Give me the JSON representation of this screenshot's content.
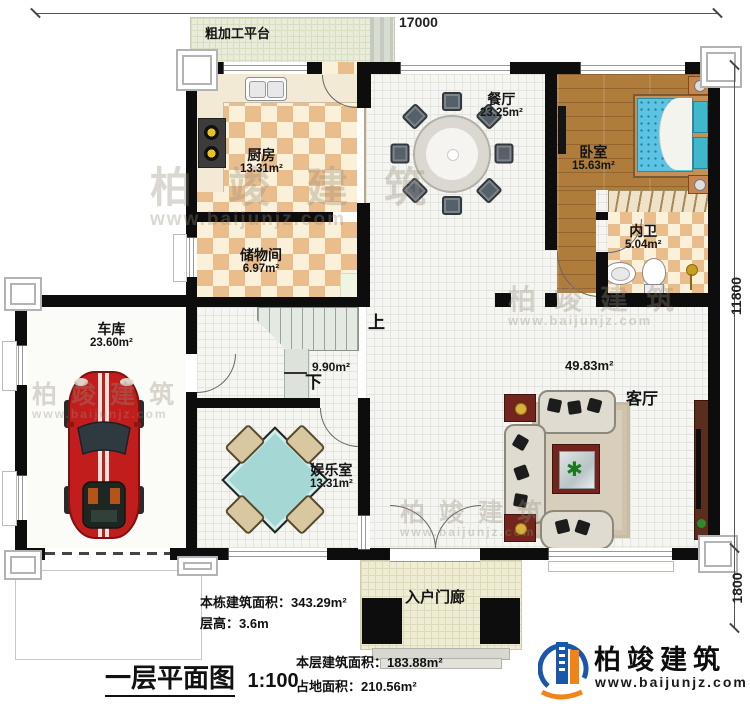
{
  "plan": {
    "title": "一层平面图",
    "scale": "1:100",
    "dims": {
      "width_top": "17000",
      "height_right": "11800",
      "porch_right": "1800"
    },
    "rooms": {
      "kitchen": {
        "label": "厨房",
        "area": "13.31m²"
      },
      "storage": {
        "label": "储物间",
        "area": "6.97m²"
      },
      "dining": {
        "label": "餐厅",
        "area": "23.25m²"
      },
      "bedroom": {
        "label": "卧室",
        "area": "15.63m²"
      },
      "bathroom": {
        "label": "内卫",
        "area": "5.04m²"
      },
      "garage": {
        "label": "车库",
        "area": "23.60m²"
      },
      "entertainment": {
        "label": "娱乐室",
        "area": "13.31m²"
      },
      "living": {
        "label": "客厅",
        "area": "49.83m²"
      },
      "stairs": {
        "area": "9.90m²",
        "up": "上",
        "down": "下"
      },
      "platform": {
        "label": "粗加工平台"
      },
      "porch": {
        "label": "入户门廊"
      }
    },
    "notes": {
      "total_area": "本栋建筑面积：343.29m²",
      "floor_height": "层高：3.6m",
      "floor_area": "本层建筑面积：183.88m²",
      "footprint": "占地面积：210.56m²"
    },
    "brand": {
      "name": "柏竣建筑",
      "site": "www.baijunjz.com"
    },
    "watermark": {
      "name": "柏竣建筑",
      "site": "www.baijunjz.com"
    },
    "colors": {
      "wall": "#0d0d0d",
      "brand_blue": "#1a57aa",
      "brand_orange": "#f08418",
      "car_red": "#c21d1d",
      "bed_blue": "#5bc4e4"
    }
  }
}
